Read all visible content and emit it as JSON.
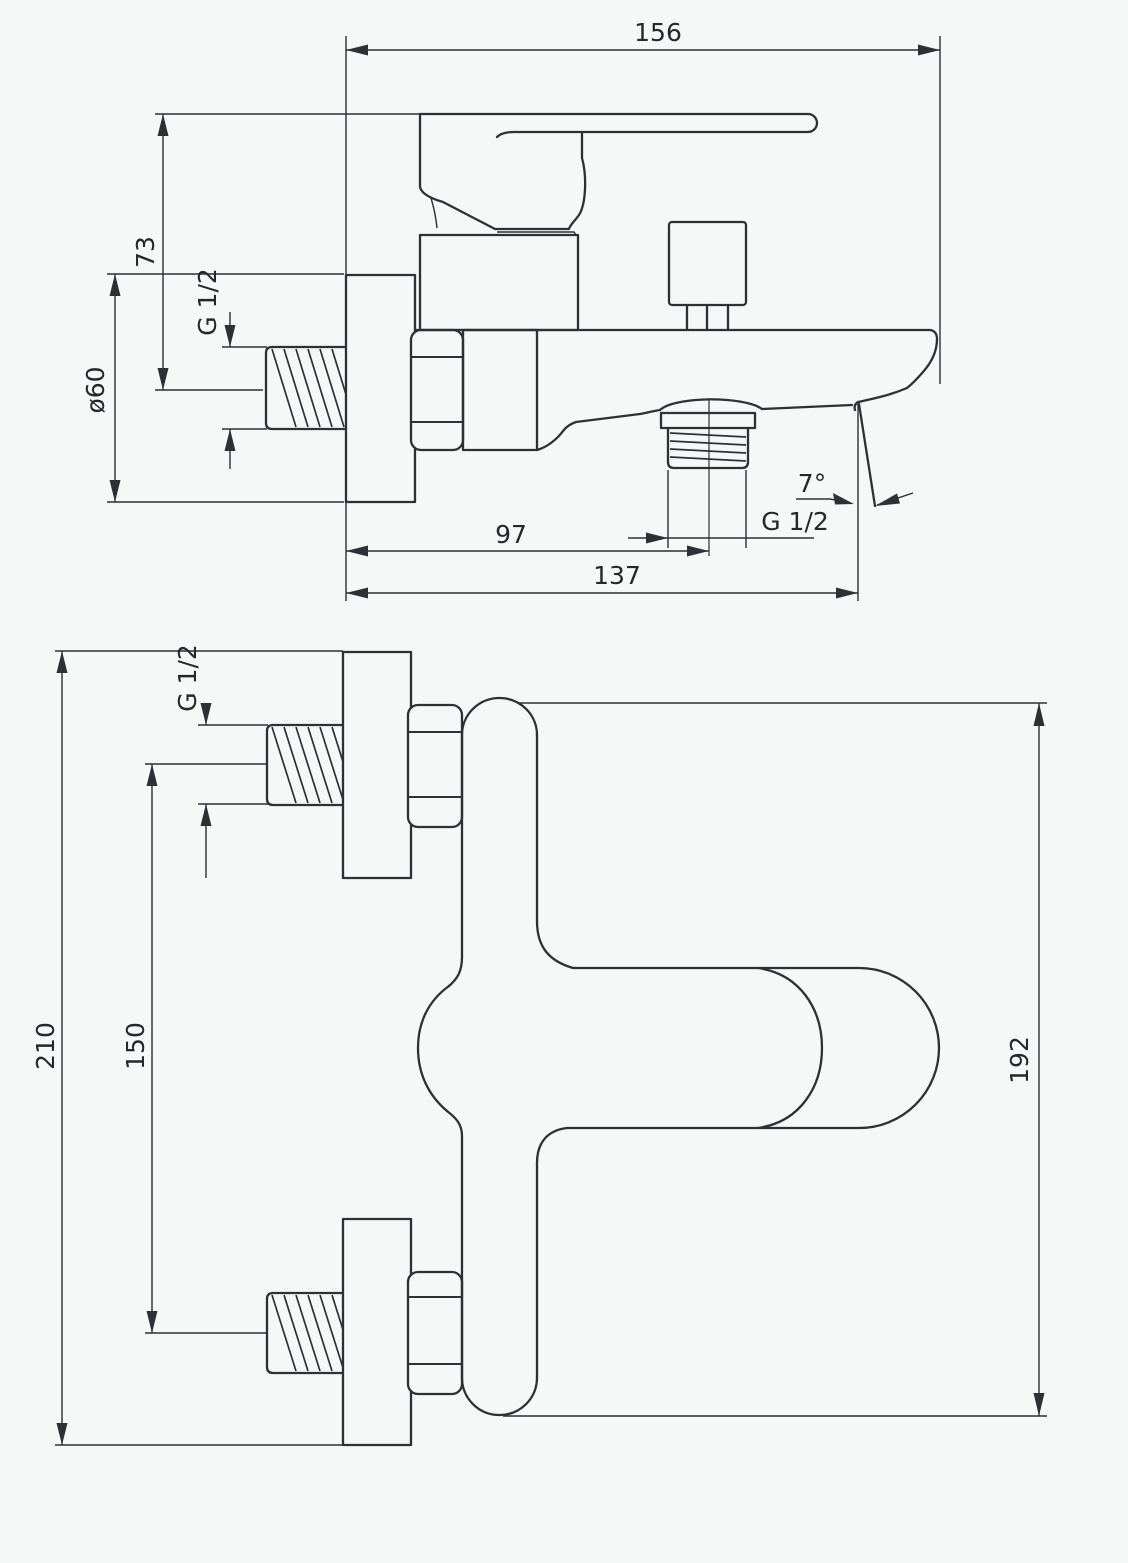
{
  "drawing": {
    "background_color": "#f6f7f7",
    "line_color": "#2d3134",
    "side_view": {
      "width": "156",
      "handle_height": "73",
      "escutcheon_diameter": "ø60",
      "inlet_thread": "G 1/2",
      "spout_center": "97",
      "outlet_thread": "G 1/2",
      "spout_angle": "7°",
      "depth": "137"
    },
    "front_view": {
      "overall_width": "210",
      "connection_centers": "150",
      "inlet_thread": "G 1/2",
      "body_length": "192"
    }
  }
}
